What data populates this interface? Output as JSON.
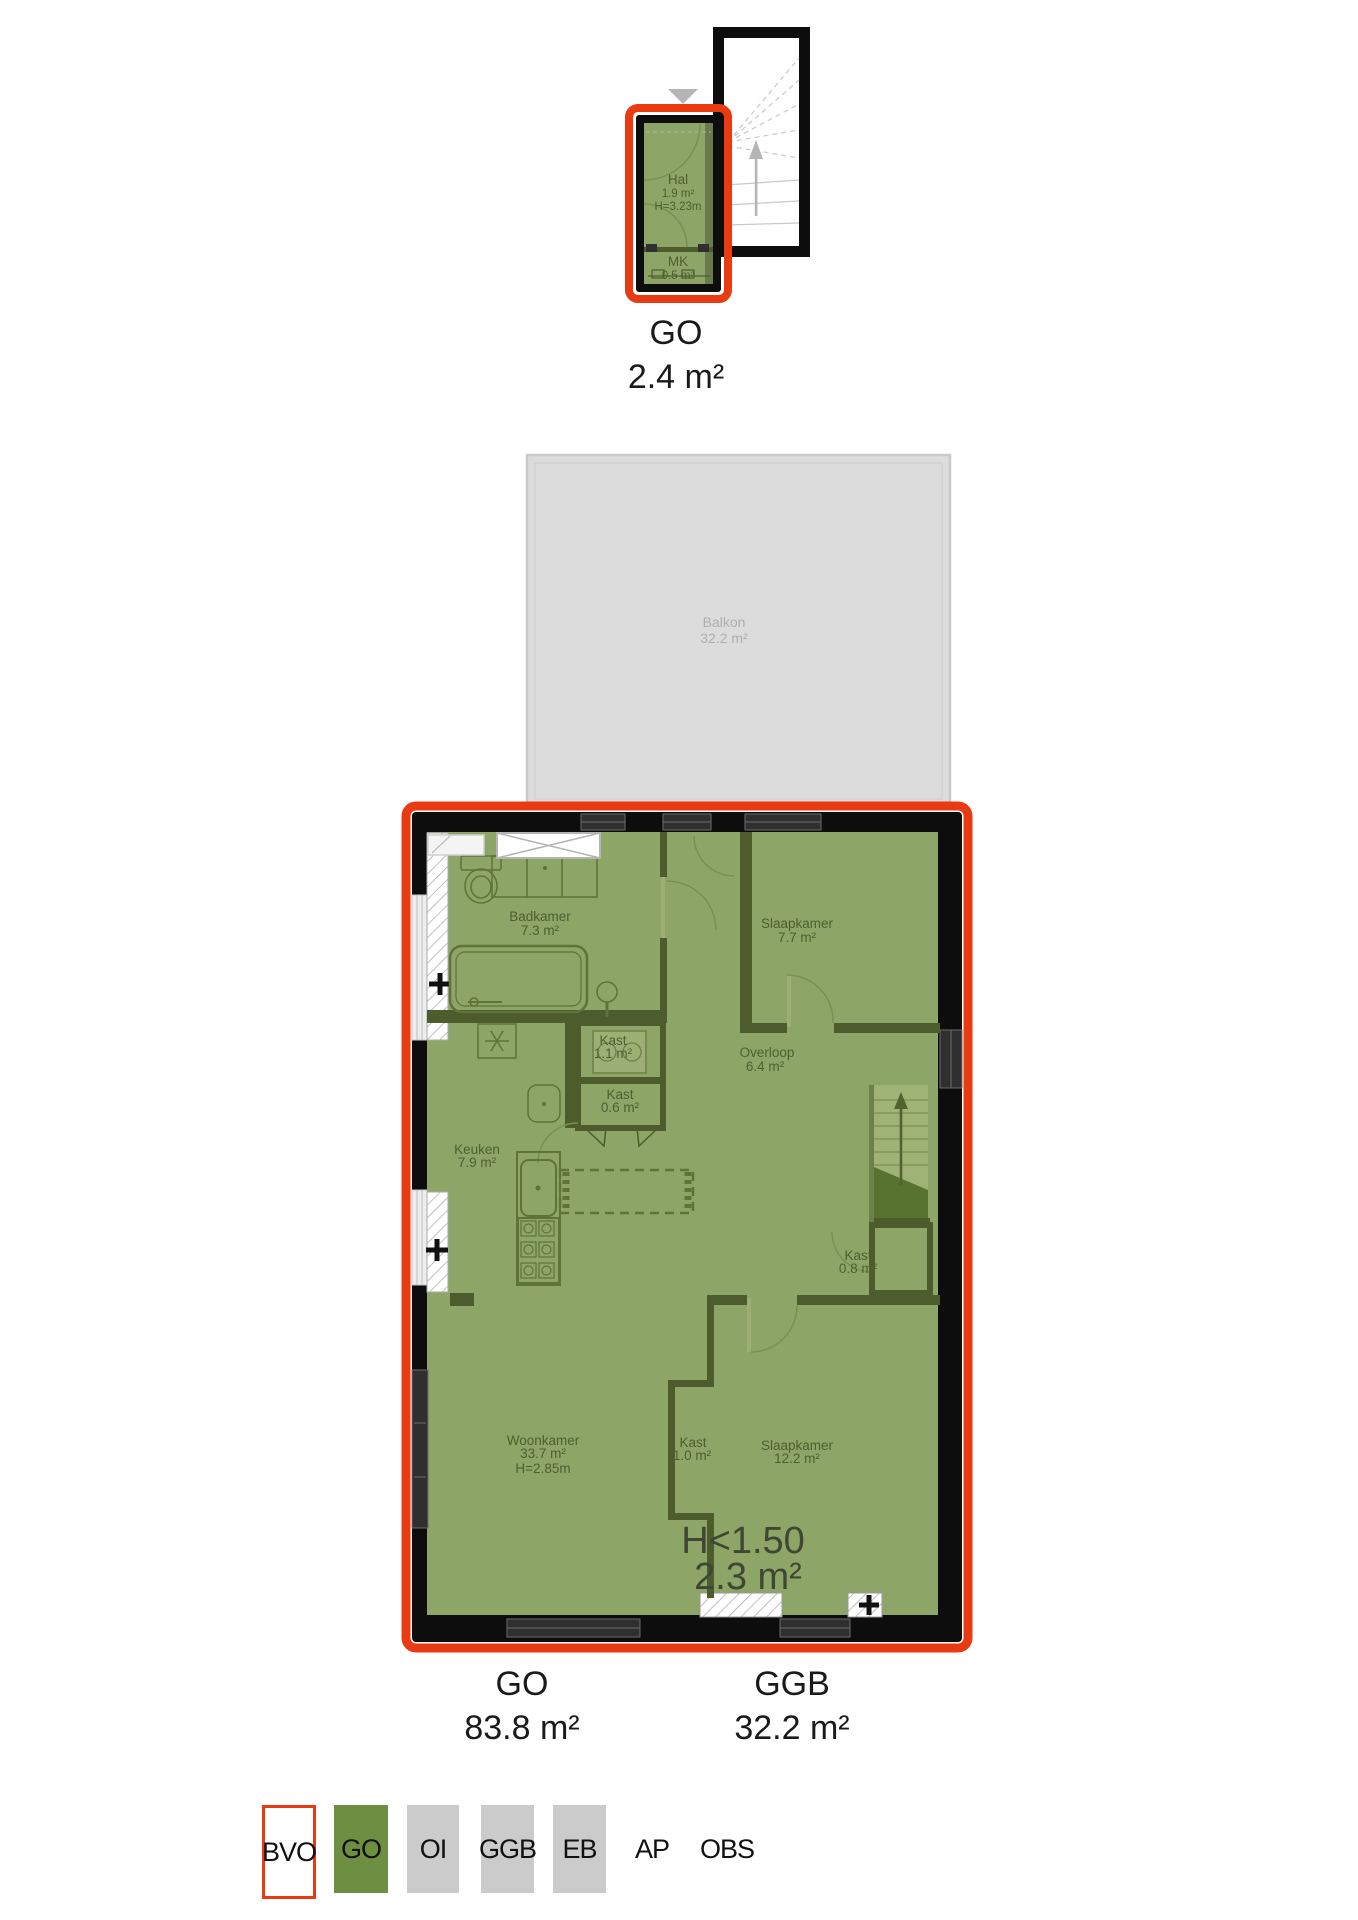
{
  "upper_plan": {
    "hal": {
      "name": "Hal",
      "area": "1.9 m²",
      "height": "H=3.23m"
    },
    "mk": {
      "name": "MK",
      "area": "0.5 m²"
    },
    "summary": {
      "code": "GO",
      "area": "2.4 m²"
    }
  },
  "main_plan": {
    "balkon": {
      "name": "Balkon",
      "area": "32.2 m²"
    },
    "badkamer": {
      "name": "Badkamer",
      "area": "7.3 m²"
    },
    "slaapkamer_1": {
      "name": "Slaapkamer",
      "area": "7.7 m²"
    },
    "kast_11": {
      "name": "Kast",
      "area": "1.1 m²"
    },
    "kast_06": {
      "name": "Kast",
      "area": "0.6 m²"
    },
    "overloop": {
      "name": "Overloop",
      "area": "6.4 m²"
    },
    "keuken": {
      "name": "Keuken",
      "area": "7.9 m²"
    },
    "kast_08": {
      "name": "Kast",
      "area": "0.8 m²"
    },
    "woonkamer": {
      "name": "Woonkamer",
      "area": "33.7 m²",
      "height": "H=2.85m"
    },
    "kast_10": {
      "name": "Kast",
      "area": "1.0 m²"
    },
    "slaapkamer_2": {
      "name": "Slaapkamer",
      "area": "12.2 m²"
    },
    "low_headroom": {
      "label": "H<1.50",
      "area": "2.3 m²"
    },
    "summary_go": {
      "code": "GO",
      "area": "83.8 m²"
    },
    "summary_ggb": {
      "code": "GGB",
      "area": "32.2 m²"
    }
  },
  "legend": {
    "items": [
      {
        "label": "BVO",
        "swatch": "red-outline"
      },
      {
        "label": "GO",
        "swatch": "green"
      },
      {
        "label": "OI",
        "swatch": "gray"
      },
      {
        "label": "GGB",
        "swatch": "gray"
      },
      {
        "label": "EB",
        "swatch": "gray"
      },
      {
        "label": "AP",
        "swatch": "none"
      },
      {
        "label": "OBS",
        "swatch": "none"
      }
    ]
  },
  "colors": {
    "bvo_red": "#e93a12",
    "go_green": "#6e8e41",
    "room_green": "#8da667",
    "wall_olive": "#4c5c2c",
    "neutral_gray": "#cbcbcb",
    "balkon_gray": "#dcdcdc"
  }
}
